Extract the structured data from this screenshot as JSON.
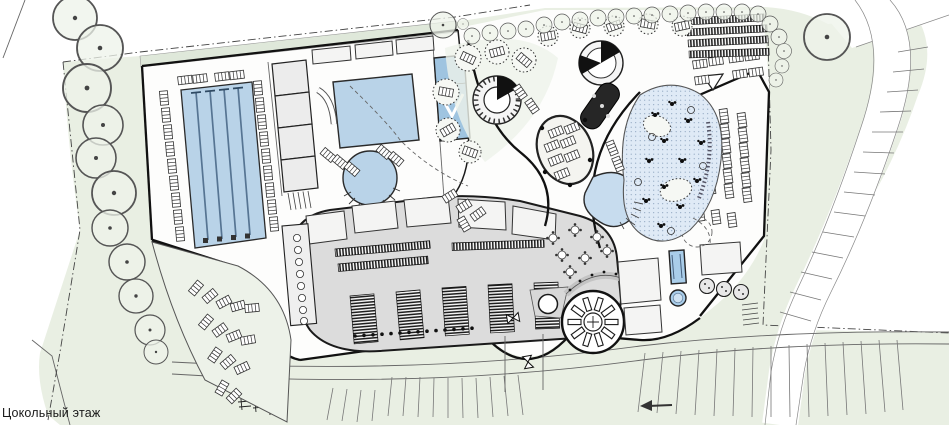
{
  "title": {
    "floor_label": "Цокольный этаж"
  },
  "palette": {
    "site_green": "#e9efe3",
    "terrace_green": "#edf2e9",
    "canopy_green": "#dfe8da",
    "pool_blue": "#b9d3e8",
    "beach_pool_blue": "#dfeaf6",
    "plunge_blue": "#a9cde9",
    "locker_gray": "#dcdcdc",
    "wall_black": "#1a1a1a"
  },
  "features": {
    "lap_pool": "lap-pool",
    "leisure_pool": "leisure-pool",
    "round_pool": "round-pool",
    "slide_tower": "slide-tower",
    "locker_block": "locker-block",
    "beach_pool": "beach-pool",
    "kidney_pool": "kidney-pool",
    "sun_wheel": "whirlpool-sun-wheel",
    "direction_arrow": "left-arrow-icon"
  }
}
